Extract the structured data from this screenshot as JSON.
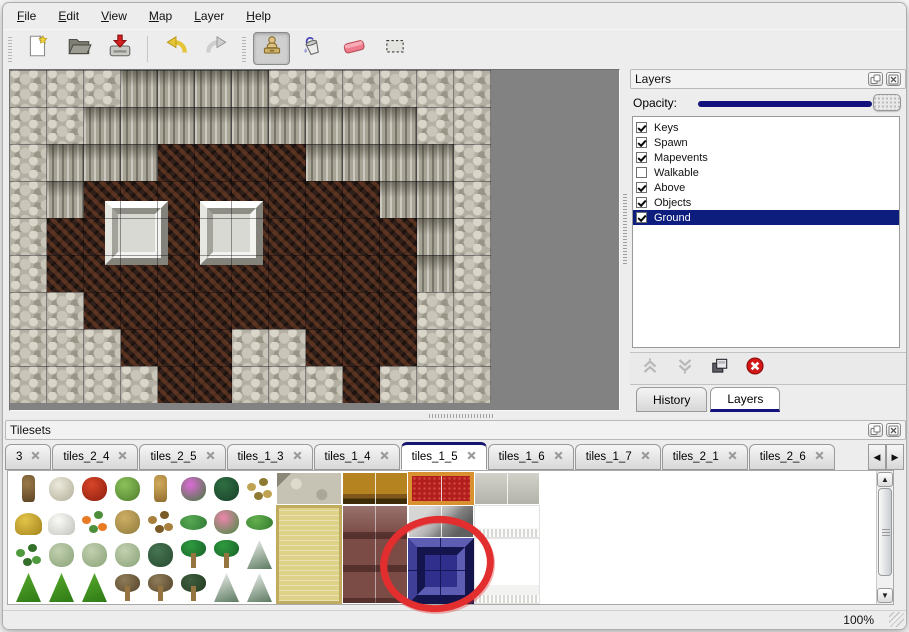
{
  "menu": {
    "items": [
      "File",
      "Edit",
      "View",
      "Map",
      "Layer",
      "Help"
    ]
  },
  "toolbar": {
    "groups": [
      [
        "new-file",
        "open-folder",
        "save"
      ],
      [
        "undo",
        "redo"
      ],
      [
        "stamp",
        "fill-bucket",
        "eraser",
        "select-rect"
      ]
    ],
    "active_tool": "stamp"
  },
  "map_editor": {
    "tile_size": 37,
    "legend": {
      "G": "stone-ground",
      "C": "cliff-wall",
      "B": "dirt-floor"
    },
    "rows": [
      "GGGCCCCGGGGGG",
      "GGCCCCCCCCCGG",
      "GCCCBBBBCCCCG",
      "GCBBBBBBBBCCG",
      "GBBBBBBBBBBCG",
      "GBBBBBBBBBBCG",
      "GGBBBBBBBBBGG",
      "GGGBBBGGBBBGG",
      "GGGGBBGGGBGGG"
    ],
    "platforms": [
      {
        "x": 95,
        "y": 131
      },
      {
        "x": 190,
        "y": 131
      }
    ]
  },
  "layers_panel": {
    "title": "Layers",
    "opacity_label": "Opacity:",
    "opacity_value": 100,
    "layers": [
      {
        "name": "Keys",
        "checked": true,
        "selected": false
      },
      {
        "name": "Spawn",
        "checked": true,
        "selected": false
      },
      {
        "name": "Mapevents",
        "checked": true,
        "selected": false
      },
      {
        "name": "Walkable",
        "checked": false,
        "selected": false
      },
      {
        "name": "Above",
        "checked": true,
        "selected": false
      },
      {
        "name": "Objects",
        "checked": true,
        "selected": false
      },
      {
        "name": "Ground",
        "checked": true,
        "selected": true
      }
    ],
    "action_icons": [
      "move-layer-up",
      "move-layer-down",
      "duplicate-layer",
      "delete-layer"
    ],
    "tabs": [
      {
        "label": "History",
        "active": false
      },
      {
        "label": "Layers",
        "active": true
      }
    ]
  },
  "tilesets_panel": {
    "title": "Tilesets",
    "tabs": [
      {
        "label": "3",
        "active": false
      },
      {
        "label": "tiles_2_4",
        "active": false
      },
      {
        "label": "tiles_2_5",
        "active": false
      },
      {
        "label": "tiles_1_3",
        "active": false
      },
      {
        "label": "tiles_1_4",
        "active": false
      },
      {
        "label": "tiles_1_5",
        "active": true
      },
      {
        "label": "tiles_1_6",
        "active": false
      },
      {
        "label": "tiles_1_7",
        "active": false
      },
      {
        "label": "tiles_2_1",
        "active": false
      },
      {
        "label": "tiles_2_6",
        "active": false
      }
    ],
    "plants": [
      [
        "tree-trunk",
        "dead-shrub",
        "red-flower",
        "stump",
        "tan-trunk",
        "purple-flowers",
        "fern",
        "weed"
      ],
      [
        "hay-mound",
        "snow-mound",
        "orange-flowers",
        "dry-grass",
        "leaves",
        "lily-pads",
        "pink-flowers",
        "lily-pad"
      ],
      [
        "sprouts",
        "pale-shrub",
        "pale-shrub",
        "pale-shrub",
        "dark-shrub",
        "palm",
        "palm",
        "snow-pine"
      ],
      [
        "bush",
        "bush",
        "bush",
        "dead-tree",
        "dead-tree",
        "dark-tree",
        "snow-pine",
        "snow-pine"
      ]
    ],
    "blocks": [
      {
        "col": 8,
        "row": 0,
        "w": 2,
        "h": 1,
        "kind": "stone-floor"
      },
      {
        "col": 8,
        "row": 1,
        "w": 2,
        "h": 3,
        "kind": "tatami"
      },
      {
        "col": 10,
        "row": 0,
        "w": 2,
        "h": 1,
        "kind": "wood-table"
      },
      {
        "col": 10,
        "row": 1,
        "w": 2,
        "h": 3,
        "kind": "maroon-table"
      },
      {
        "col": 12,
        "row": 0,
        "w": 2,
        "h": 1,
        "kind": "red-carpet"
      },
      {
        "col": 12,
        "row": 1,
        "w": 2,
        "h": 1,
        "kind": "metal-frame"
      },
      {
        "col": 12,
        "row": 2,
        "w": 2,
        "h": 2,
        "kind": "blue-block",
        "selected": true
      },
      {
        "col": 14,
        "row": 0,
        "w": 2,
        "h": 1,
        "kind": "silver-tile"
      },
      {
        "col": 14,
        "row": 1,
        "w": 2,
        "h": 1,
        "kind": "curtain-top"
      },
      {
        "col": 14,
        "row": 2,
        "w": 2,
        "h": 2,
        "kind": "curtain"
      }
    ],
    "annotation": {
      "shape": "red-circle",
      "color": "#e22e2e",
      "target": "blue-block"
    }
  },
  "status_bar": {
    "zoom_level": "100%"
  },
  "colors": {
    "accent_navy": "#12127c",
    "selection_bg": "#0d1d7e",
    "annotation_red": "#e22e2e"
  }
}
